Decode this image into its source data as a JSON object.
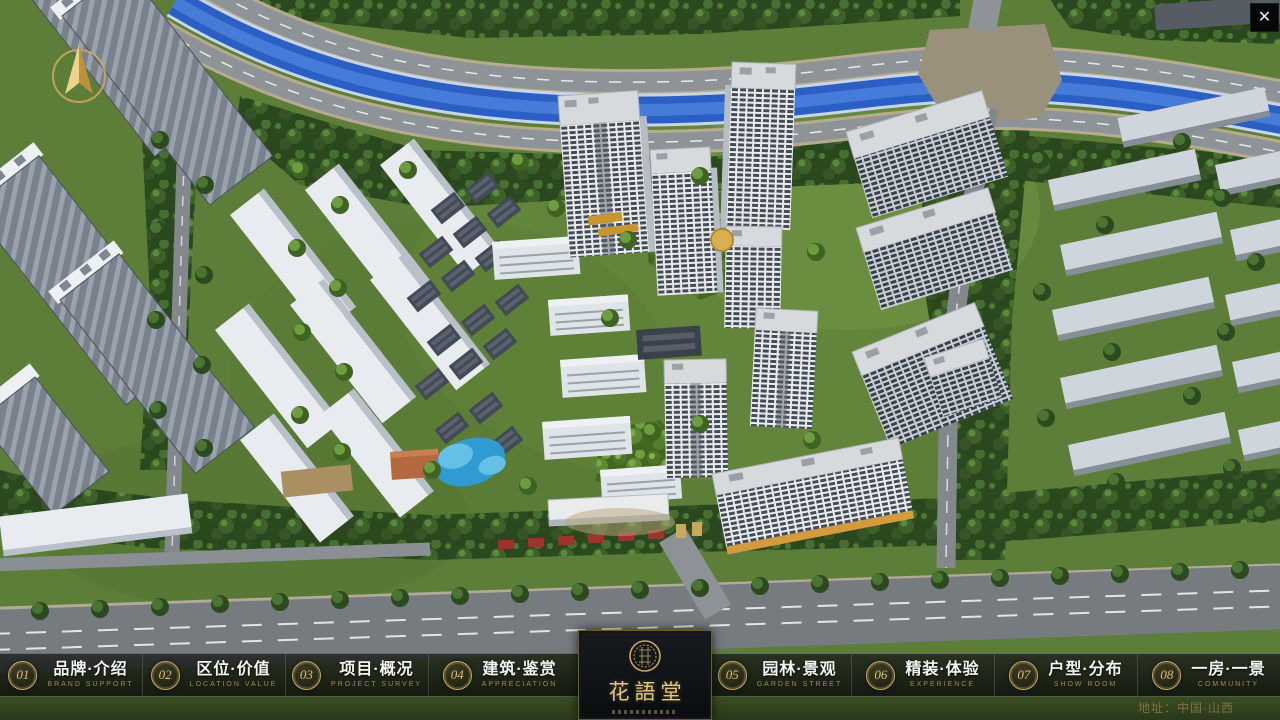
{
  "window": {
    "close_icon": "✕"
  },
  "scene": {
    "description": "aerial 3D masterplan render of residential community",
    "colors": {
      "grass": "#5d7e39",
      "forest": "#2a471e",
      "river": "#2b5fc4",
      "road": "#8e9398",
      "tower_facade": "#e9ecef",
      "tower_window": "#454c56",
      "pool": "#2f9bd0",
      "accent_gold": "#c9a85c"
    }
  },
  "nav": {
    "items": [
      {
        "number": "01",
        "label": "品牌·介绍",
        "caption": "BRAND SUPPORT"
      },
      {
        "number": "02",
        "label": "区位·价值",
        "caption": "LOCATION VALUE"
      },
      {
        "number": "03",
        "label": "项目·概况",
        "caption": "PROJECT SURVEY"
      },
      {
        "number": "04",
        "label": "建筑·鉴赏",
        "caption": "APPRECIATION"
      },
      {
        "number": "05",
        "label": "园林·景观",
        "caption": "GARDEN STREET"
      },
      {
        "number": "06",
        "label": "精装·体验",
        "caption": "EXPERIENCE"
      },
      {
        "number": "07",
        "label": "户型·分布",
        "caption": "SHOW ROOM"
      },
      {
        "number": "08",
        "label": "一房·一景",
        "caption": "COMMUNITY"
      }
    ]
  },
  "logo": {
    "title": "花語堂"
  },
  "footer": {
    "address": "地址：中国·山西"
  }
}
